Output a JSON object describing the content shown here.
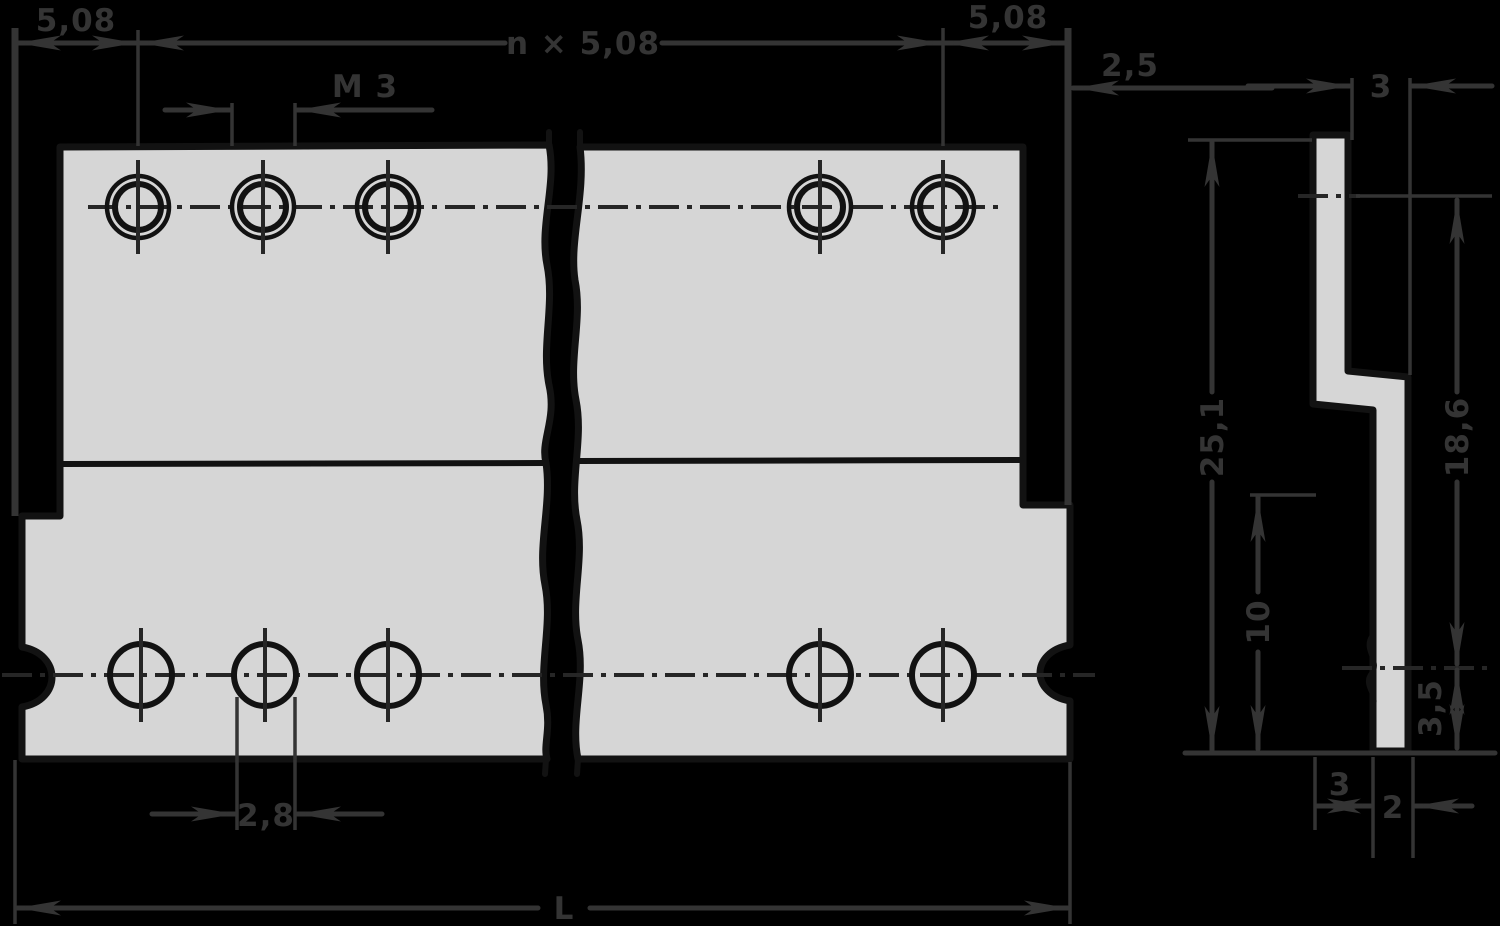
{
  "drawing": {
    "type": "technical-dimension-drawing",
    "colors": {
      "background": "#000000",
      "part": "#d6d6d6",
      "outline": "#121212",
      "annotation": "#343434"
    },
    "views": {
      "front": {
        "label": "front-view-of-slotted-mounting-strip"
      },
      "side": {
        "label": "side-profile-view"
      }
    },
    "dimensions": {
      "pitch_left": "5,08",
      "pitch_total": "n × 5,08",
      "pitch_right": "5,08",
      "end_offset": "2,5",
      "thread_size": "M 3",
      "hole_diameter": "2,8",
      "overall_length": "L",
      "overall_height": "25,1",
      "row_spacing": "18,6",
      "lower_leg_height": "10",
      "hole_to_edge": "3,5",
      "upper_thickness": "3",
      "step_depth": "3",
      "lower_thickness": "2"
    }
  }
}
